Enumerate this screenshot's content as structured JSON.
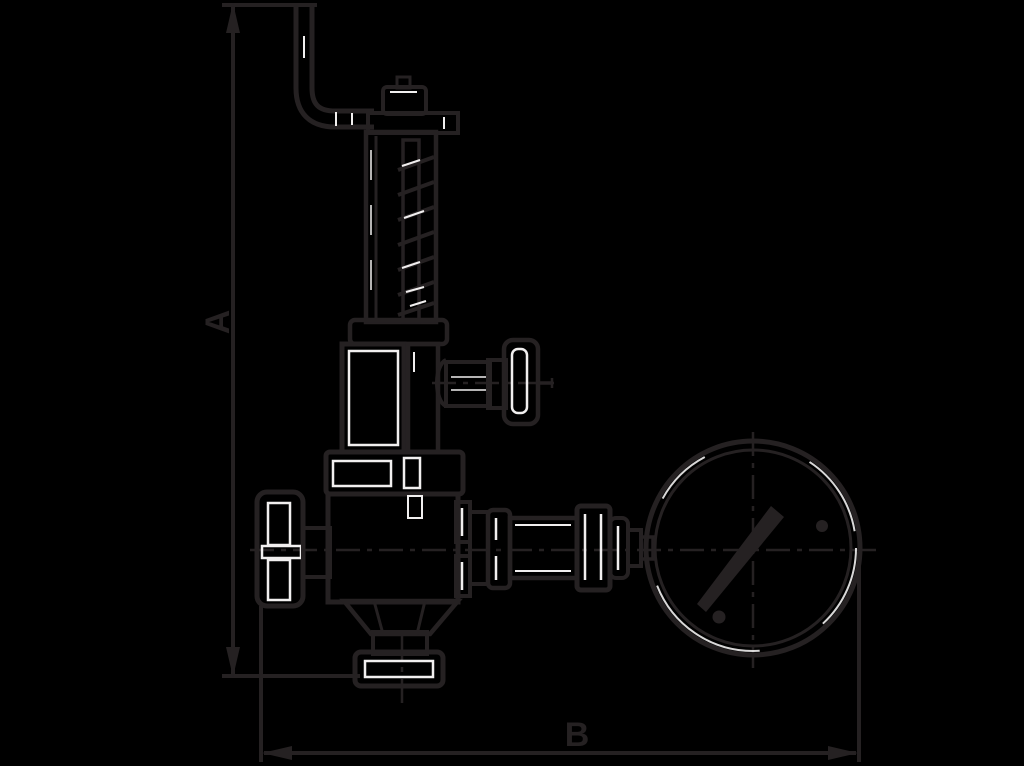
{
  "drawing": {
    "type": "technical-outline-drawing",
    "subject": "spring-loaded valve with pressure gauge, overall dimension drawing",
    "background_color": "#000000",
    "ink_color": "#252122",
    "highlight_color": "#f1efef",
    "dimension_labels": {
      "vertical": "A",
      "horizontal": "B"
    }
  }
}
